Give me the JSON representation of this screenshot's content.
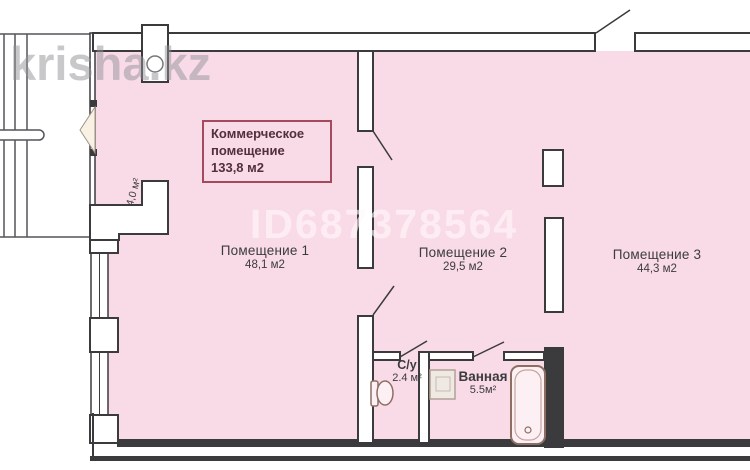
{
  "watermarks": {
    "site": "krisha.kz",
    "listing_id": "ID687378564"
  },
  "commercial_box": {
    "line1": "Коммерческое",
    "line2": "помещение",
    "area": "133,8 м2"
  },
  "rooms": [
    {
      "name": "Помещение 1",
      "area": "48,1 м2"
    },
    {
      "name": "Помещение 2",
      "area": "29,5 м2"
    },
    {
      "name": "Помещение 3",
      "area": "44,3 м2"
    }
  ],
  "wet_rooms": {
    "toilet": {
      "name": "С/у",
      "area": "2.4 м²"
    },
    "bath": {
      "name": "Ванная",
      "area": "5.5м²"
    }
  },
  "niche": {
    "area": "4,0 м²"
  },
  "colors": {
    "floor": "#f9dbe8",
    "walls": "#3b3b3d",
    "label_box_border": "#a34a5e",
    "label_box_text": "#532e3c",
    "room_text": "#3b3b3d",
    "fixtures": "#8d6e63",
    "watermark_gray": "#919196"
  }
}
